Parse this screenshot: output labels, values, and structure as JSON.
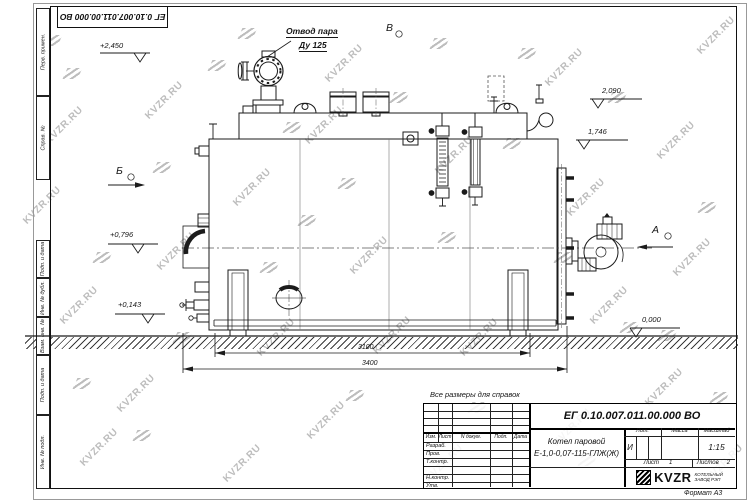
{
  "watermark": {
    "text": "KVZR.RU"
  },
  "stamp_top": {
    "doc_number": "ЕГ 0.10.007.011.00.000  ВО"
  },
  "margin_labels": [
    "Перв. примен.",
    "Справ. №",
    "Подп. и дата",
    "Инв. № дубл.",
    "Взам. инв. №",
    "Подп. и дата",
    "Инв. № подл."
  ],
  "drawing": {
    "callout": {
      "line1": "Отвод пара",
      "line2": "Ду 125"
    },
    "views": {
      "b": "Б",
      "v": "В",
      "a": "А"
    },
    "elevations": {
      "e1": "+2,450",
      "e2": "2,090",
      "e3": "1,746",
      "e4": "+0,796",
      "e5": "+0,143",
      "e6": "0,000"
    },
    "dimensions": {
      "d1": "3100",
      "d2": "3400"
    }
  },
  "note": "Все размеры для справок",
  "title_block": {
    "doc_number": "ЕГ 0.10.007.011.00.000  ВО",
    "product_line1": "Котел паровой",
    "product_line2": "Е-1,0-0,07-115-ГЛЖ(Ж)",
    "cols": {
      "izm": "Изм.",
      "list": "Лист",
      "ndoc": "N докум.",
      "podp": "Подп.",
      "data": "Дата"
    },
    "rows": {
      "razrab": "Разраб.",
      "prov": "Пров.",
      "tkontr": "Т.контр.",
      "nkontr": "Н.контр.",
      "utv": "Утв."
    },
    "lit_label": "Лит.",
    "mass_label": "Масса",
    "scale_label": "Масштаб",
    "lit_value": "И",
    "scale_value": "1:15",
    "sheet_label": "Лист",
    "sheet_value": "1",
    "sheets_label": "Листов",
    "sheets_value": "2",
    "logo_text": "KVZR",
    "logo_caption_line1": "КОТЕЛЬНЫЙ",
    "logo_caption_line2": "ЗАВОД РЭП",
    "format": "Формат А3"
  }
}
